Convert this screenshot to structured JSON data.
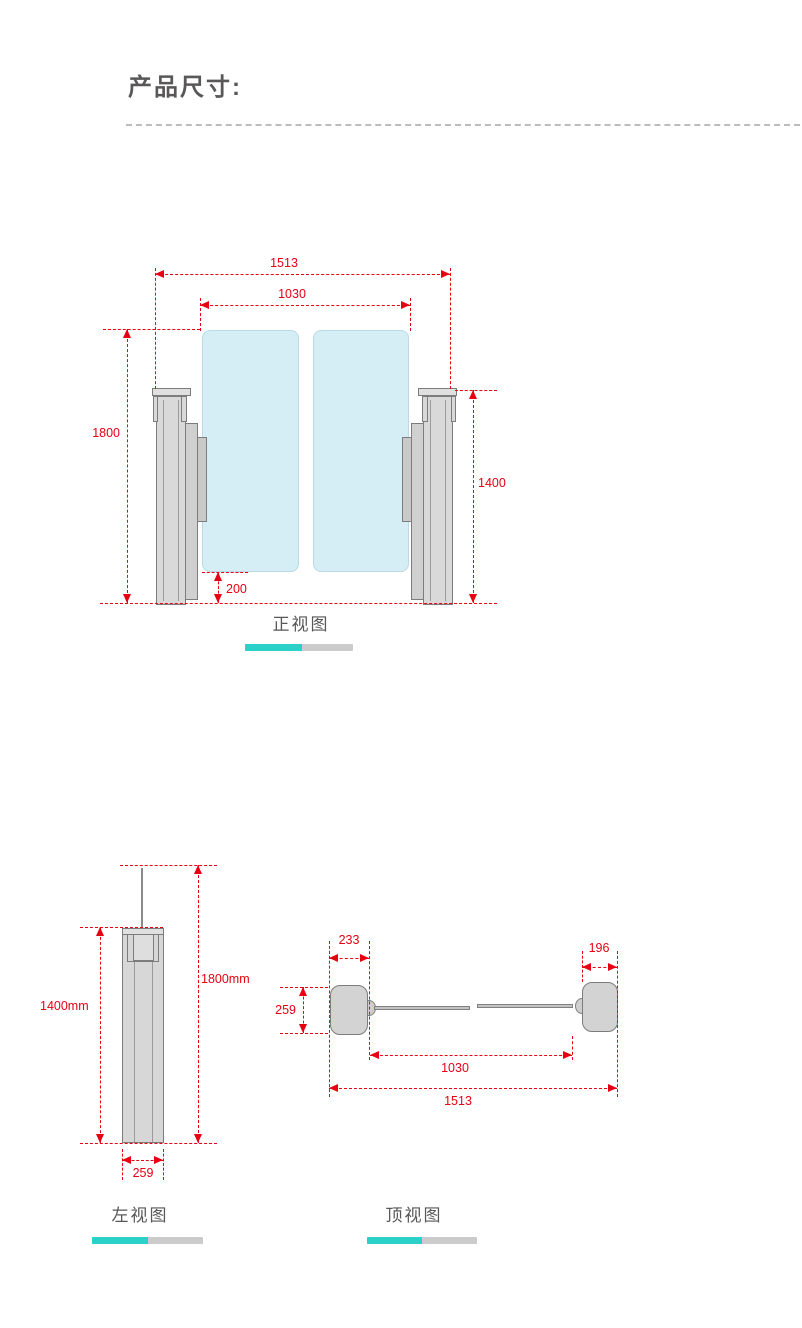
{
  "title": "产品尺寸:",
  "front": {
    "label": "正视图",
    "dims": {
      "overall_width": "1513",
      "lane_width": "1030",
      "total_height": "1800",
      "cabinet_height": "1400",
      "glass_clearance": "200"
    }
  },
  "side": {
    "label": "左视图",
    "dims": {
      "cabinet_height": "1400mm",
      "total_height": "1800mm",
      "depth": "259"
    }
  },
  "top": {
    "label": "顶视图",
    "dims": {
      "left_cabinet_width": "233",
      "right_cabinet_width": "196",
      "cabinet_depth": "259",
      "lane_width": "1030",
      "overall_width": "1513"
    }
  },
  "colors": {
    "red": "#e60012",
    "teal": "#29d1c8",
    "ink": "#595757",
    "glass": "#d5edf4",
    "metal": "#d9d9d9"
  }
}
